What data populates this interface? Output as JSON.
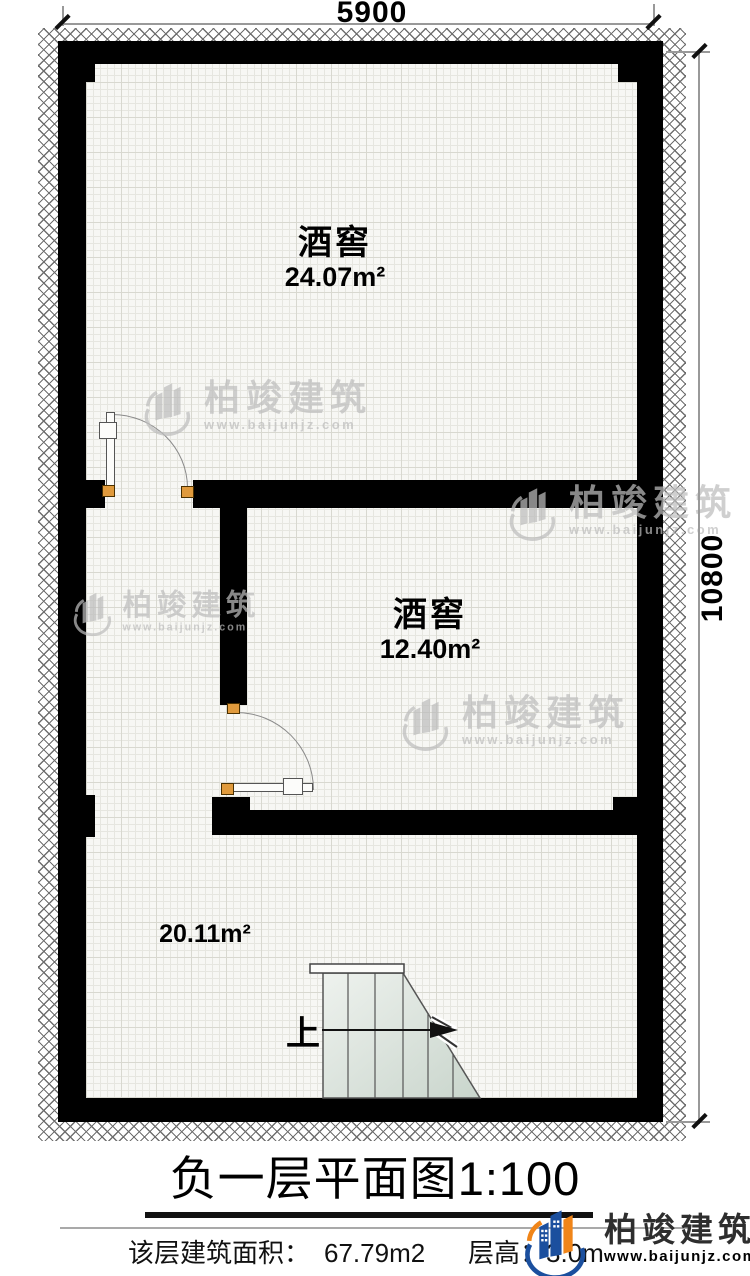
{
  "plan": {
    "dim_top": "5900",
    "dim_right": "10800",
    "rooms": [
      {
        "name": "酒窖",
        "area": "24.07m²"
      },
      {
        "name": "酒窖",
        "area": "12.40m²"
      },
      {
        "name": "",
        "area": "20.11m²"
      }
    ],
    "stair_up": "上"
  },
  "title": {
    "name": "负一层平面图",
    "scale": "1:100"
  },
  "footer": {
    "area_label": "该层建筑面积：",
    "area_value": "67.79m2",
    "height_label": "层高：",
    "height_value": "3.0m"
  },
  "brand": {
    "name": "柏竣建筑",
    "url": "www.baijunjz.com"
  },
  "watermark": {
    "name": "柏竣建筑",
    "url": "www.baijunjz.com"
  },
  "colors": {
    "wall": "#000000",
    "hinge": "#e09a3c",
    "logo_blue": "#1b4f9e",
    "logo_orange": "#f08519",
    "stair_fill": "#dde6dd",
    "watermark_gray": "#bdbdbd"
  }
}
